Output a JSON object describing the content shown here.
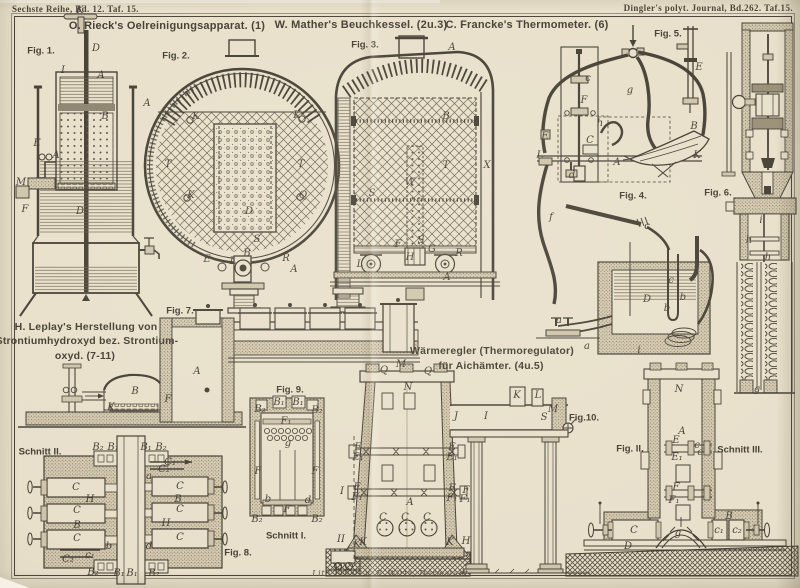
{
  "page": {
    "header_left": "Sechste Reihe, Bd. 12. Taf. 15.",
    "header_right": "Dingler's polyt. Journal, Bd.262. Taf.15.",
    "credit": "Lith. Anst. v. F. Wirtz, Darmstadt.",
    "paper_color": "#e8e0cb",
    "ink_color": "#453f34"
  },
  "titles": {
    "rieck": "O. Rieck's Oelreinigungsapparat. (1)",
    "mather": "W. Mather's Beuchkessel. (2u.3)",
    "francke": "C. Francke's Thermometer. (6)",
    "leplay": [
      "H. Leplay's Herstellung von",
      "Strontiumhydroxyd bez. Strontium-",
      "oxyd. (7-11)"
    ],
    "waermeregler": [
      "Wärmeregler (Thermoregulator)",
      "für Aichämter. (4u.5)"
    ]
  },
  "figure_labels": {
    "fig1": "Fig. 1.",
    "fig2": "Fig. 2.",
    "fig3": "Fig. 3.",
    "fig4": "Fig. 4.",
    "fig5": "Fig. 5.",
    "fig6": "Fig. 6.",
    "fig7": "Fig. 7.",
    "fig8": "Fig. 8.",
    "fig9": "Fig. 9.",
    "fig10": "Fig.10.",
    "fig11": "Fig. II.",
    "schnitt1": "Schnitt I.",
    "schnitt2": "Schnitt II.",
    "schnitt3": "Schnitt III."
  },
  "part_labels": {
    "fig1": [
      {
        "t": "K",
        "x": 80,
        "y": 11
      },
      {
        "t": "D",
        "x": 96,
        "y": 49
      },
      {
        "t": "I",
        "x": 63,
        "y": 71
      },
      {
        "t": "A",
        "x": 101,
        "y": 76
      },
      {
        "t": "B",
        "x": 105,
        "y": 117
      },
      {
        "t": "E",
        "x": 37,
        "y": 144
      },
      {
        "t": "A",
        "x": 56,
        "y": 156
      },
      {
        "t": "M",
        "x": 21,
        "y": 183
      },
      {
        "t": "F",
        "x": 25,
        "y": 210
      },
      {
        "t": "D",
        "x": 80,
        "y": 212
      }
    ],
    "fig2": [
      {
        "t": "A",
        "x": 147,
        "y": 104
      },
      {
        "t": "K",
        "x": 196,
        "y": 117
      },
      {
        "t": "K",
        "x": 297,
        "y": 116
      },
      {
        "t": "T",
        "x": 168,
        "y": 165
      },
      {
        "t": "T",
        "x": 301,
        "y": 165
      },
      {
        "t": "K",
        "x": 191,
        "y": 196
      },
      {
        "t": "Q",
        "x": 303,
        "y": 196
      },
      {
        "t": "D",
        "x": 249,
        "y": 212
      },
      {
        "t": "S",
        "x": 257,
        "y": 240
      },
      {
        "t": "E",
        "x": 207,
        "y": 260
      },
      {
        "t": "B",
        "x": 247,
        "y": 254
      },
      {
        "t": "L",
        "x": 233,
        "y": 262
      },
      {
        "t": "R",
        "x": 286,
        "y": 259
      },
      {
        "t": "A",
        "x": 294,
        "y": 270
      }
    ],
    "fig3": [
      {
        "t": "A",
        "x": 452,
        "y": 48
      },
      {
        "t": "B",
        "x": 446,
        "y": 117
      },
      {
        "t": "T",
        "x": 446,
        "y": 166
      },
      {
        "t": "X",
        "x": 487,
        "y": 166
      },
      {
        "t": "S",
        "x": 372,
        "y": 194
      },
      {
        "t": "W",
        "x": 410,
        "y": 183
      },
      {
        "t": "F",
        "x": 398,
        "y": 245
      },
      {
        "t": "S",
        "x": 421,
        "y": 241
      },
      {
        "t": "G",
        "x": 432,
        "y": 250
      },
      {
        "t": "H",
        "x": 410,
        "y": 258
      },
      {
        "t": "R",
        "x": 459,
        "y": 254
      },
      {
        "t": "L",
        "x": 360,
        "y": 265
      },
      {
        "t": "A",
        "x": 447,
        "y": 278
      }
    ],
    "fig4": [
      {
        "t": "c",
        "x": 588,
        "y": 79
      },
      {
        "t": "F",
        "x": 584,
        "y": 101
      },
      {
        "t": "g",
        "x": 630,
        "y": 91
      },
      {
        "t": "h",
        "x": 600,
        "y": 124
      },
      {
        "t": "C",
        "x": 590,
        "y": 141
      },
      {
        "t": "E",
        "x": 545,
        "y": 137
      },
      {
        "t": "L",
        "x": 540,
        "y": 156
      },
      {
        "t": "A",
        "x": 617,
        "y": 163
      },
      {
        "t": "B",
        "x": 694,
        "y": 127
      },
      {
        "t": "K",
        "x": 697,
        "y": 156
      },
      {
        "t": "d",
        "x": 572,
        "y": 176
      },
      {
        "t": "f",
        "x": 551,
        "y": 218
      },
      {
        "t": "c",
        "x": 647,
        "y": 227
      },
      {
        "t": "D",
        "x": 647,
        "y": 300
      },
      {
        "t": "c",
        "x": 671,
        "y": 281
      },
      {
        "t": "b",
        "x": 667,
        "y": 309
      },
      {
        "t": "b",
        "x": 683,
        "y": 298
      },
      {
        "t": "a",
        "x": 559,
        "y": 321
      },
      {
        "t": "a",
        "x": 587,
        "y": 347
      },
      {
        "t": "i",
        "x": 639,
        "y": 351
      }
    ],
    "fig5": [
      {
        "t": "E",
        "x": 699,
        "y": 68
      }
    ],
    "fig6": [
      {
        "t": "i",
        "x": 761,
        "y": 221
      },
      {
        "t": "h",
        "x": 749,
        "y": 241
      },
      {
        "t": "h",
        "x": 768,
        "y": 258
      },
      {
        "t": "g",
        "x": 757,
        "y": 390
      }
    ],
    "fig7": [
      {
        "t": "A",
        "x": 197,
        "y": 372
      },
      {
        "t": "B",
        "x": 135,
        "y": 392
      },
      {
        "t": "K",
        "x": 111,
        "y": 408
      },
      {
        "t": "F",
        "x": 168,
        "y": 400
      }
    ],
    "fig8": [
      {
        "t": "B₂",
        "x": 98,
        "y": 448
      },
      {
        "t": "B₁",
        "x": 113,
        "y": 448
      },
      {
        "t": "B₁",
        "x": 146,
        "y": 448
      },
      {
        "t": "B₂",
        "x": 161,
        "y": 448
      },
      {
        "t": "a",
        "x": 149,
        "y": 477
      },
      {
        "t": "C",
        "x": 76,
        "y": 488
      },
      {
        "t": "C",
        "x": 180,
        "y": 487
      },
      {
        "t": "H",
        "x": 90,
        "y": 500
      },
      {
        "t": "B",
        "x": 178,
        "y": 500
      },
      {
        "t": "C",
        "x": 77,
        "y": 511
      },
      {
        "t": "C",
        "x": 180,
        "y": 510
      },
      {
        "t": "B",
        "x": 77,
        "y": 526
      },
      {
        "t": "H",
        "x": 166,
        "y": 524
      },
      {
        "t": "C",
        "x": 77,
        "y": 539
      },
      {
        "t": "C",
        "x": 180,
        "y": 538
      },
      {
        "t": "C₁",
        "x": 170,
        "y": 463
      },
      {
        "t": "C₂",
        "x": 164,
        "y": 470
      },
      {
        "t": "b",
        "x": 109,
        "y": 547
      },
      {
        "t": "d",
        "x": 149,
        "y": 547
      },
      {
        "t": "c₁",
        "x": 90,
        "y": 556
      },
      {
        "t": "C₂",
        "x": 68,
        "y": 560
      },
      {
        "t": "B₂",
        "x": 93,
        "y": 573
      },
      {
        "t": "B₁",
        "x": 119,
        "y": 574
      },
      {
        "t": "B₁",
        "x": 132,
        "y": 574
      },
      {
        "t": "B₂",
        "x": 154,
        "y": 574
      }
    ],
    "fig9": [
      {
        "t": "B₁",
        "x": 279,
        "y": 403
      },
      {
        "t": "B₁",
        "x": 298,
        "y": 403
      },
      {
        "t": "B₂",
        "x": 260,
        "y": 410
      },
      {
        "t": "B₂",
        "x": 317,
        "y": 411
      },
      {
        "t": "F₁",
        "x": 286,
        "y": 422
      },
      {
        "t": "g",
        "x": 288,
        "y": 444
      },
      {
        "t": "F",
        "x": 258,
        "y": 472
      },
      {
        "t": "F",
        "x": 315,
        "y": 472
      },
      {
        "t": "b",
        "x": 268,
        "y": 500
      },
      {
        "t": "d",
        "x": 308,
        "y": 501
      },
      {
        "t": "F",
        "x": 287,
        "y": 510
      },
      {
        "t": "B₂",
        "x": 257,
        "y": 520
      },
      {
        "t": "B₂",
        "x": 317,
        "y": 520
      }
    ],
    "fig10": [
      {
        "t": "M",
        "x": 401,
        "y": 365
      },
      {
        "t": "Q",
        "x": 384,
        "y": 371
      },
      {
        "t": "Q",
        "x": 428,
        "y": 372
      },
      {
        "t": "N",
        "x": 408,
        "y": 388
      },
      {
        "t": "K",
        "x": 517,
        "y": 396
      },
      {
        "t": "L",
        "x": 538,
        "y": 396
      },
      {
        "t": "J",
        "x": 456,
        "y": 417
      },
      {
        "t": "I",
        "x": 486,
        "y": 417
      },
      {
        "t": "S",
        "x": 544,
        "y": 418
      },
      {
        "t": "M",
        "x": 553,
        "y": 410
      },
      {
        "t": "E",
        "x": 358,
        "y": 448
      },
      {
        "t": "E₁",
        "x": 358,
        "y": 458
      },
      {
        "t": "E",
        "x": 452,
        "y": 448
      },
      {
        "t": "E₁",
        "x": 452,
        "y": 458
      },
      {
        "t": "F",
        "x": 357,
        "y": 488
      },
      {
        "t": "F₁",
        "x": 357,
        "y": 498
      },
      {
        "t": "F",
        "x": 452,
        "y": 489
      },
      {
        "t": "F₁",
        "x": 452,
        "y": 499
      },
      {
        "t": "F",
        "x": 466,
        "y": 491
      },
      {
        "t": "F₁",
        "x": 465,
        "y": 500
      },
      {
        "t": "A",
        "x": 410,
        "y": 503
      },
      {
        "t": "C",
        "x": 383,
        "y": 518
      },
      {
        "t": "C",
        "x": 405,
        "y": 518
      },
      {
        "t": "C",
        "x": 427,
        "y": 518
      },
      {
        "t": "K",
        "x": 363,
        "y": 543
      },
      {
        "t": "K",
        "x": 450,
        "y": 543
      },
      {
        "t": "H",
        "x": 466,
        "y": 542
      },
      {
        "t": "I",
        "x": 342,
        "y": 492
      },
      {
        "t": "II",
        "x": 341,
        "y": 540
      },
      {
        "t": "K",
        "x": 357,
        "y": 545
      }
    ],
    "fig11": [
      {
        "t": "N",
        "x": 679,
        "y": 390
      },
      {
        "t": "A",
        "x": 682,
        "y": 432
      },
      {
        "t": "E",
        "x": 676,
        "y": 441
      },
      {
        "t": "E₁",
        "x": 677,
        "y": 458
      },
      {
        "t": "c",
        "x": 697,
        "y": 446
      },
      {
        "t": "c",
        "x": 700,
        "y": 453
      },
      {
        "t": "F",
        "x": 676,
        "y": 488
      },
      {
        "t": "F₁",
        "x": 674,
        "y": 501
      },
      {
        "t": "C",
        "x": 634,
        "y": 531
      },
      {
        "t": "D",
        "x": 628,
        "y": 547
      },
      {
        "t": "B",
        "x": 729,
        "y": 517
      },
      {
        "t": "c₁",
        "x": 719,
        "y": 531
      },
      {
        "t": "c₂",
        "x": 737,
        "y": 531
      },
      {
        "t": "g",
        "x": 678,
        "y": 534
      }
    ]
  }
}
